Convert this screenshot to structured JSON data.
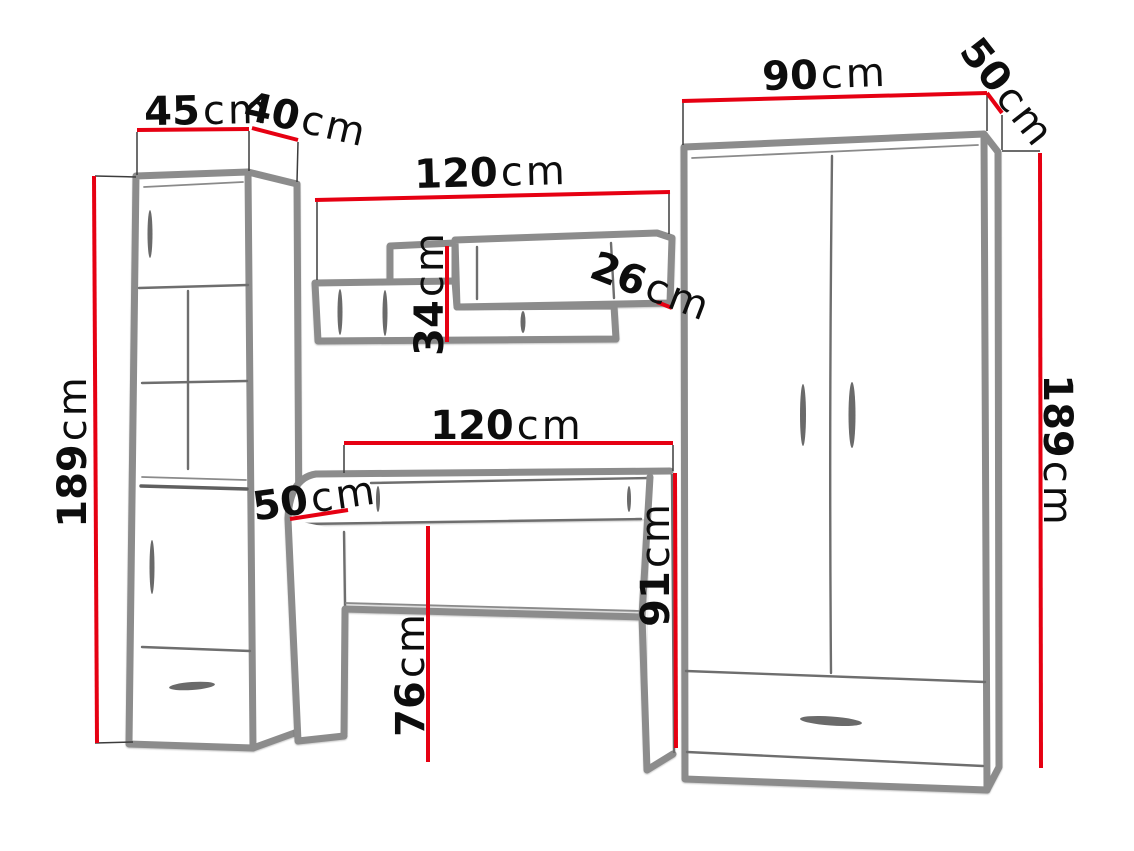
{
  "diagram": {
    "type": "furniture-dimension-sketch",
    "background": "#ffffff"
  },
  "colors": {
    "dimension_line": "#e60012",
    "sketch_stroke": "#8c8c8c",
    "label_text": "#0d0d0d"
  },
  "dims": {
    "cabinet_width": {
      "value": "45",
      "unit": "cm"
    },
    "cabinet_depth": {
      "value": "40",
      "unit": "cm"
    },
    "cabinet_height": {
      "value": "189",
      "unit": "cm"
    },
    "shelf_width": {
      "value": "120",
      "unit": "cm"
    },
    "shelf_height": {
      "value": "34",
      "unit": "cm"
    },
    "shelf_depth": {
      "value": "26",
      "unit": "cm"
    },
    "desk_width": {
      "value": "120",
      "unit": "cm"
    },
    "desk_depth": {
      "value": "50",
      "unit": "cm"
    },
    "desk_height": {
      "value": "76",
      "unit": "cm"
    },
    "desk_worktop_height": {
      "value": "91",
      "unit": "cm"
    },
    "wardrobe_width": {
      "value": "90",
      "unit": "cm"
    },
    "wardrobe_depth": {
      "value": "50",
      "unit": "cm"
    },
    "wardrobe_height": {
      "value": "189",
      "unit": "cm"
    }
  }
}
